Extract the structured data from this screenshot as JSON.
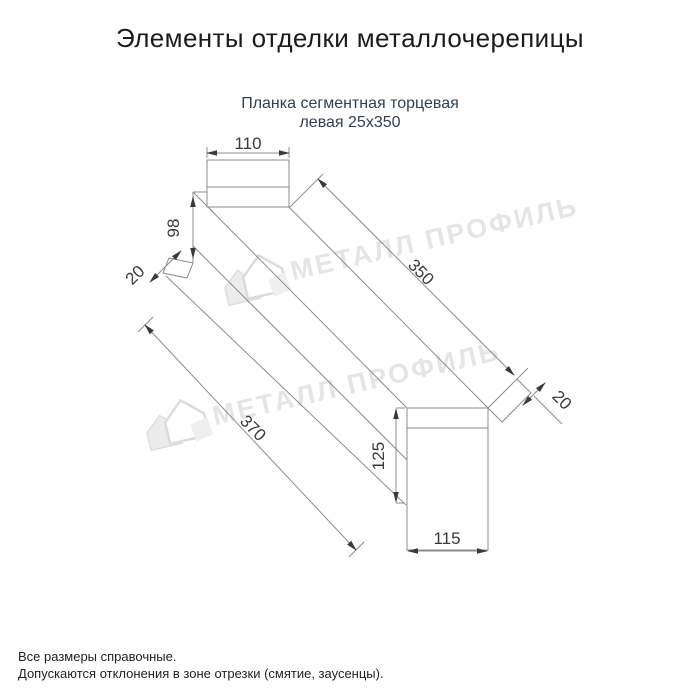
{
  "page": {
    "title": "Элементы отделки металлочерепицы",
    "product": {
      "subtitle_line1": "Планка сегментная торцевая",
      "subtitle_line2": "левая 25x350"
    },
    "footnotes": {
      "line1": "Все размеры справочные.",
      "line2": "Допускаются отклонения в зоне отрезки (смятие, заусенцы)."
    }
  },
  "watermark": {
    "brand": "МЕТАЛЛ ПРОФИЛЬ",
    "logo": "metall-profil-house-logo",
    "color": "#e5e5e5"
  },
  "drawing": {
    "type": "technical-line-drawing",
    "units": "mm",
    "dims": {
      "top_width": {
        "label": "110"
      },
      "left_height": {
        "label": "98"
      },
      "left_fold": {
        "label": "20"
      },
      "length": {
        "label": "350"
      },
      "total_length": {
        "label": "370"
      },
      "right_fold": {
        "label": "20"
      },
      "right_height": {
        "label": "125"
      },
      "bottom_width": {
        "label": "115"
      }
    }
  },
  "colors": {
    "background": "#ffffff",
    "title_text": "#1c1c1c",
    "subtitle_text": "#2f4156",
    "line": "#8c8c8c",
    "dim_text": "#3a3a3a",
    "watermark": "#e5e5e5"
  }
}
